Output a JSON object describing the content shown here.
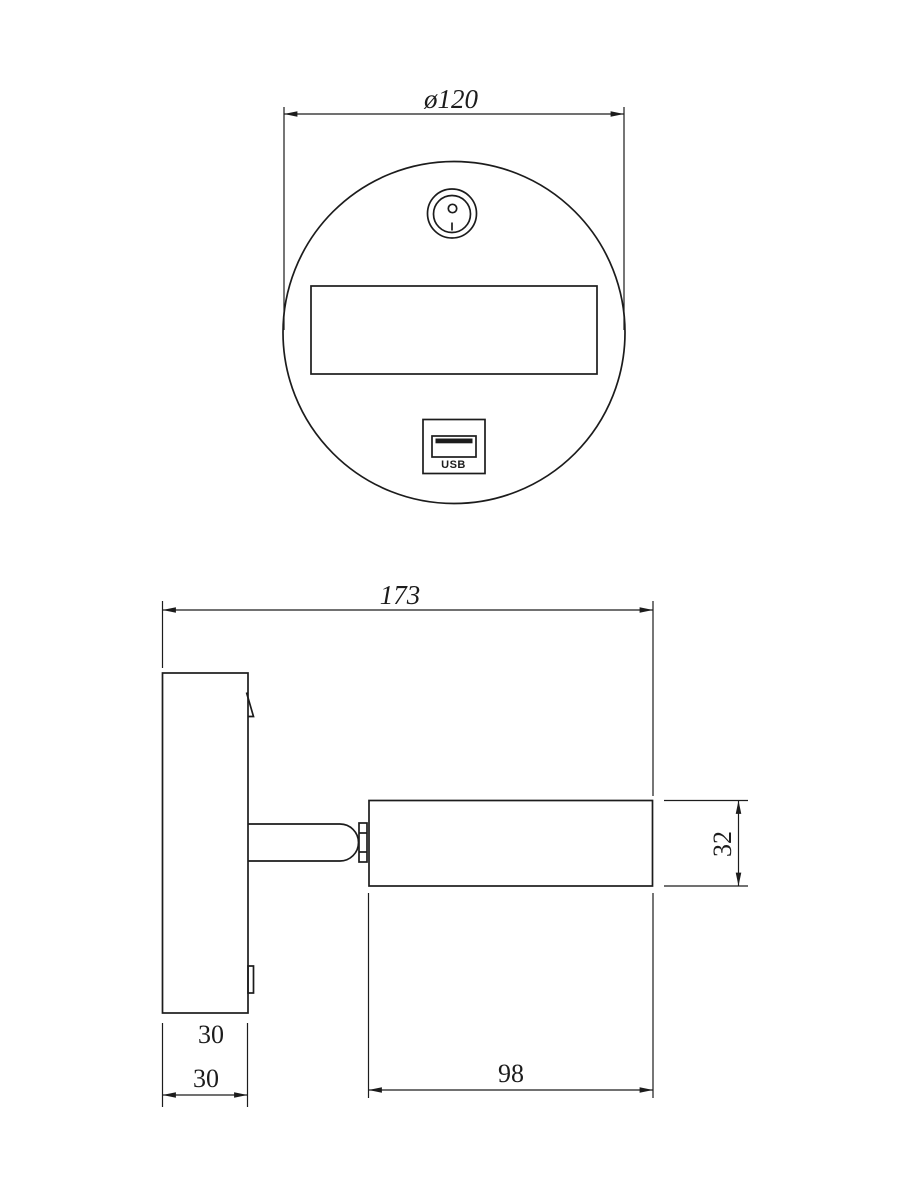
{
  "colors": {
    "line": "#1c1c1c",
    "background": "#ffffff"
  },
  "top_view": {
    "diameter_label": "ø120",
    "usb_label": "USB",
    "icons": [
      "power-switch-icon",
      "usb-port-icon"
    ]
  },
  "side_view": {
    "overall_width_label": "173",
    "head_height_label": "32",
    "head_length_label": "98",
    "plate_width_label": "30",
    "plate_depth_label": "30"
  }
}
